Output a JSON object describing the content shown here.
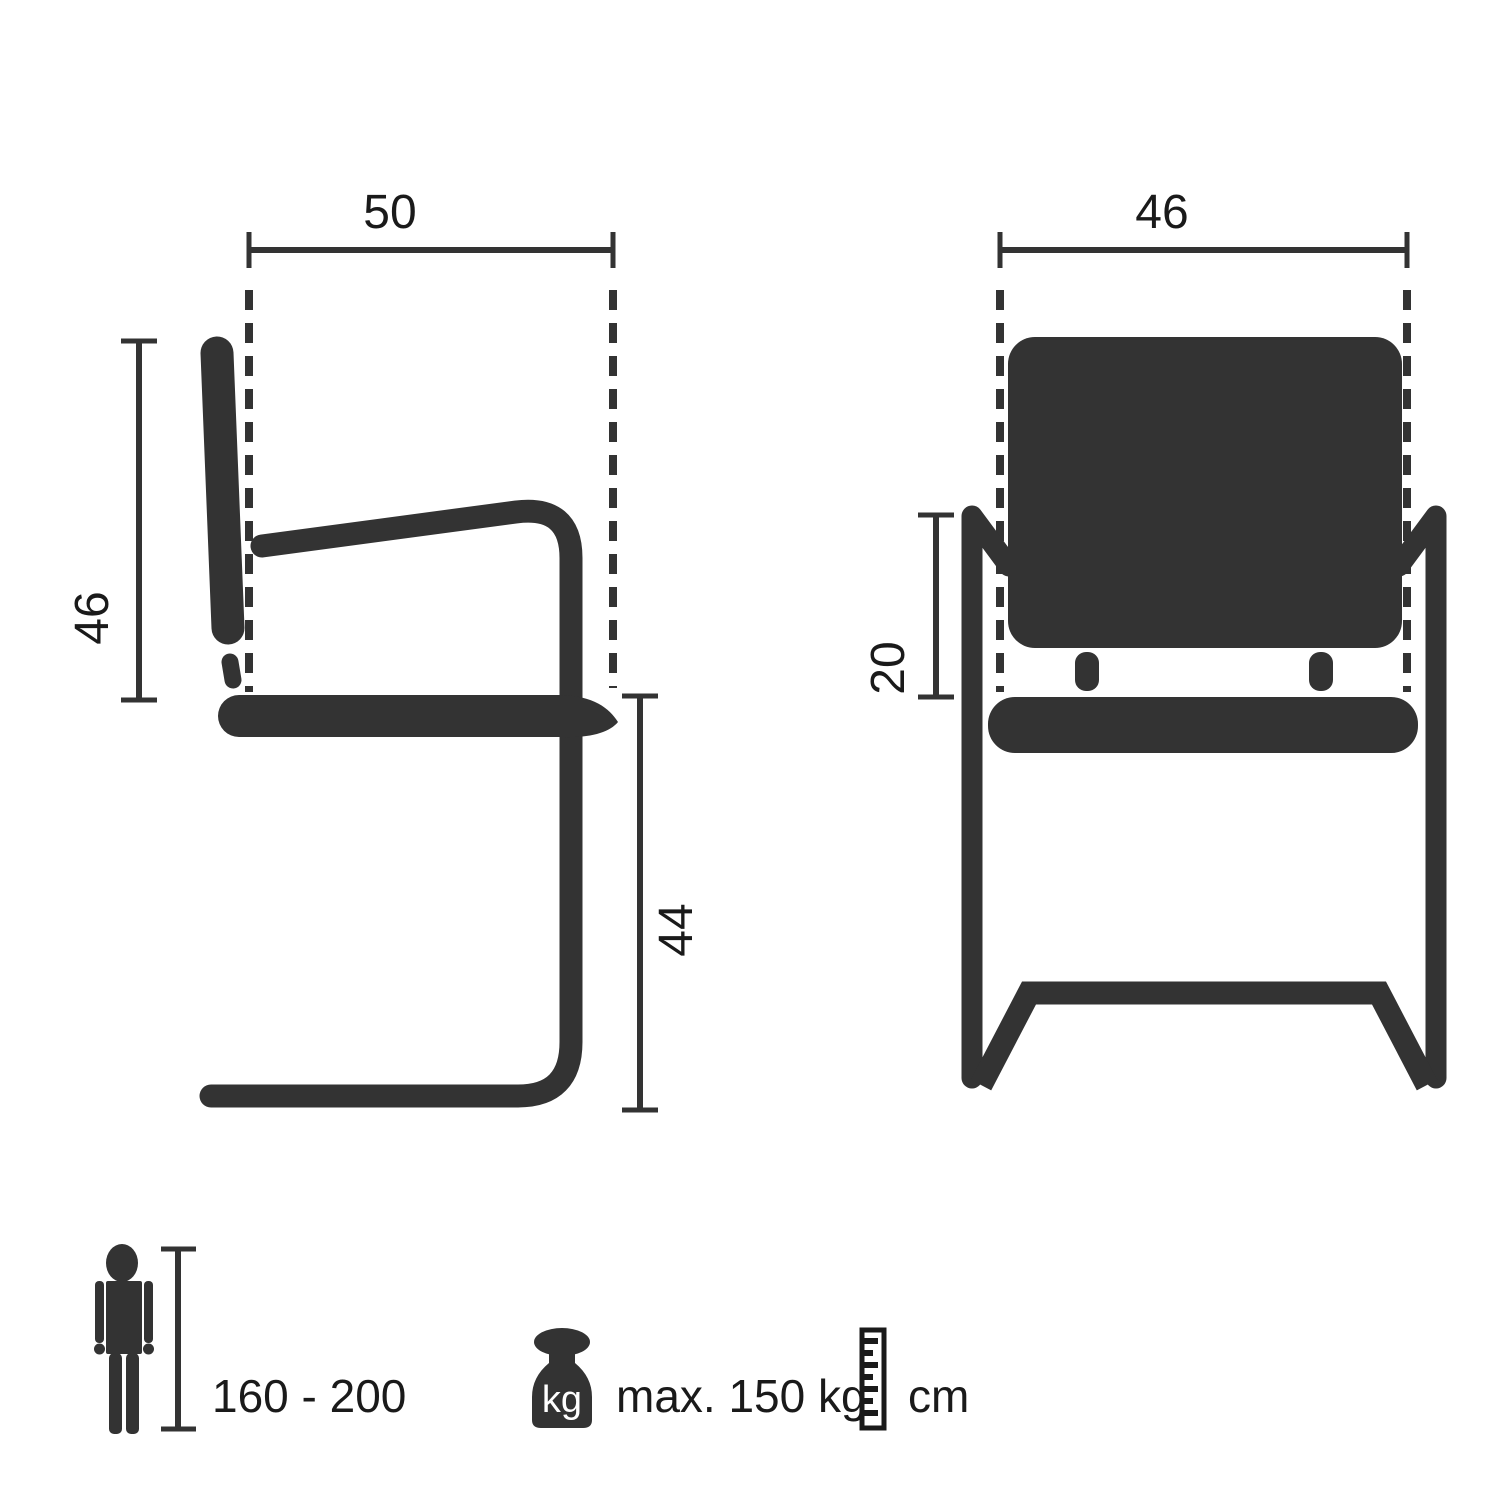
{
  "colors": {
    "ink": "#333333",
    "label_text": "#1a1a1a",
    "background": "#ffffff"
  },
  "views": {
    "side": {
      "depth_label": "50",
      "backrest_height_label": "46",
      "seat_height_label": "44"
    },
    "front": {
      "width_label": "46",
      "armrest_to_seat_label": "20"
    }
  },
  "legend": {
    "person_height_range": "160 - 200",
    "weight_unit_badge": "kg",
    "max_load": "max. 150 kg",
    "measurement_unit": "cm"
  }
}
